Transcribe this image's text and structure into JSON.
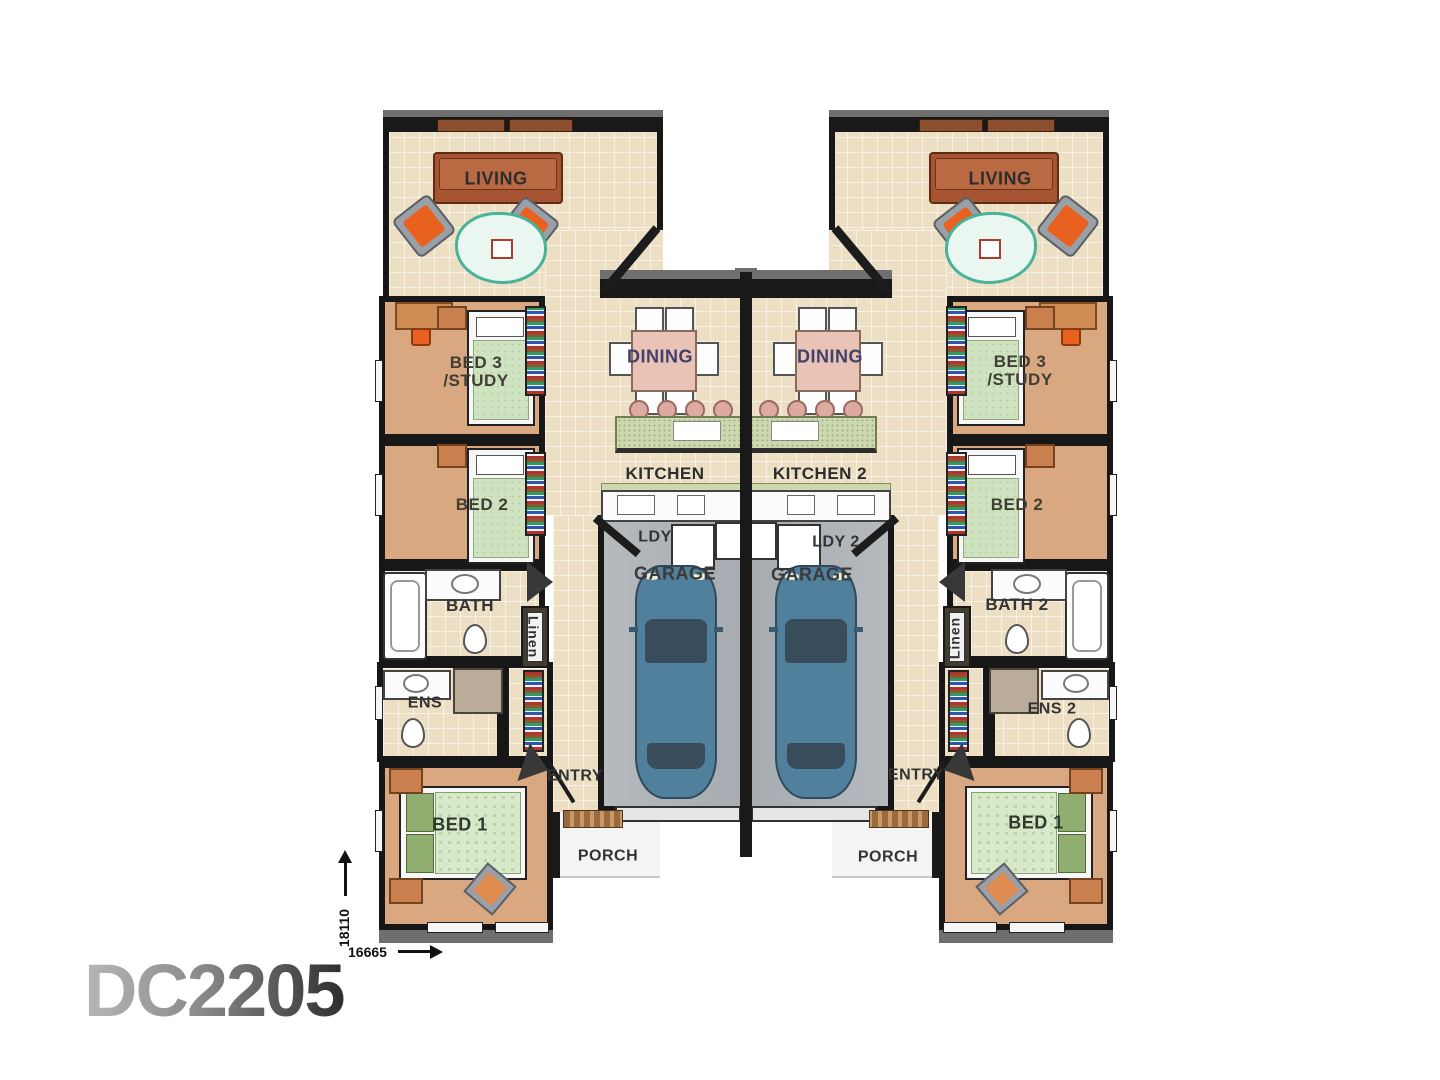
{
  "title": "DC2205",
  "dimensions": {
    "height_mm": "18110",
    "width_mm": "16665"
  },
  "unit_left": {
    "living": "LIVING",
    "bed3_line1": "BED 3",
    "bed3_line2": "/STUDY",
    "bed2": "BED 2",
    "bath": "BATH",
    "ens": "ENS",
    "bed1": "BED 1",
    "linen": "Linen",
    "dining": "DINING",
    "kitchen": "KITCHEN",
    "laundry": "LDY",
    "garage": "GARAGE",
    "entry": "ENTRY",
    "porch": "PORCH"
  },
  "unit_right": {
    "living": "LIVING",
    "bed3_line1": "BED 3",
    "bed3_line2": "/STUDY",
    "bed2": "BED 2",
    "bath": "BATH 2",
    "ens": "ENS 2",
    "bed1": "BED 1",
    "linen": "Linen",
    "dining": "DINING",
    "kitchen": "KITCHEN 2",
    "laundry": "LDY 2",
    "garage": "GARAGE",
    "entry": "ENTRY",
    "porch": "PORCH"
  },
  "colors": {
    "wall": "#171717",
    "wall_top": "#6f6f6f",
    "tile_floor": "#ecdfc4",
    "carpet_floor": "#d9a880",
    "garage_floor": "#b0b4b8",
    "sofa_brown": "#a65432",
    "chair_orange": "#e8611f",
    "bed_green": "#cfe3c0",
    "bench_green": "#ccd8ad",
    "dining_table_pink": "#e9c3b5",
    "car_blue": "#50809c",
    "car_white": "#eef0f2",
    "dining_label": "#40406a",
    "label_gray": "#333333"
  }
}
